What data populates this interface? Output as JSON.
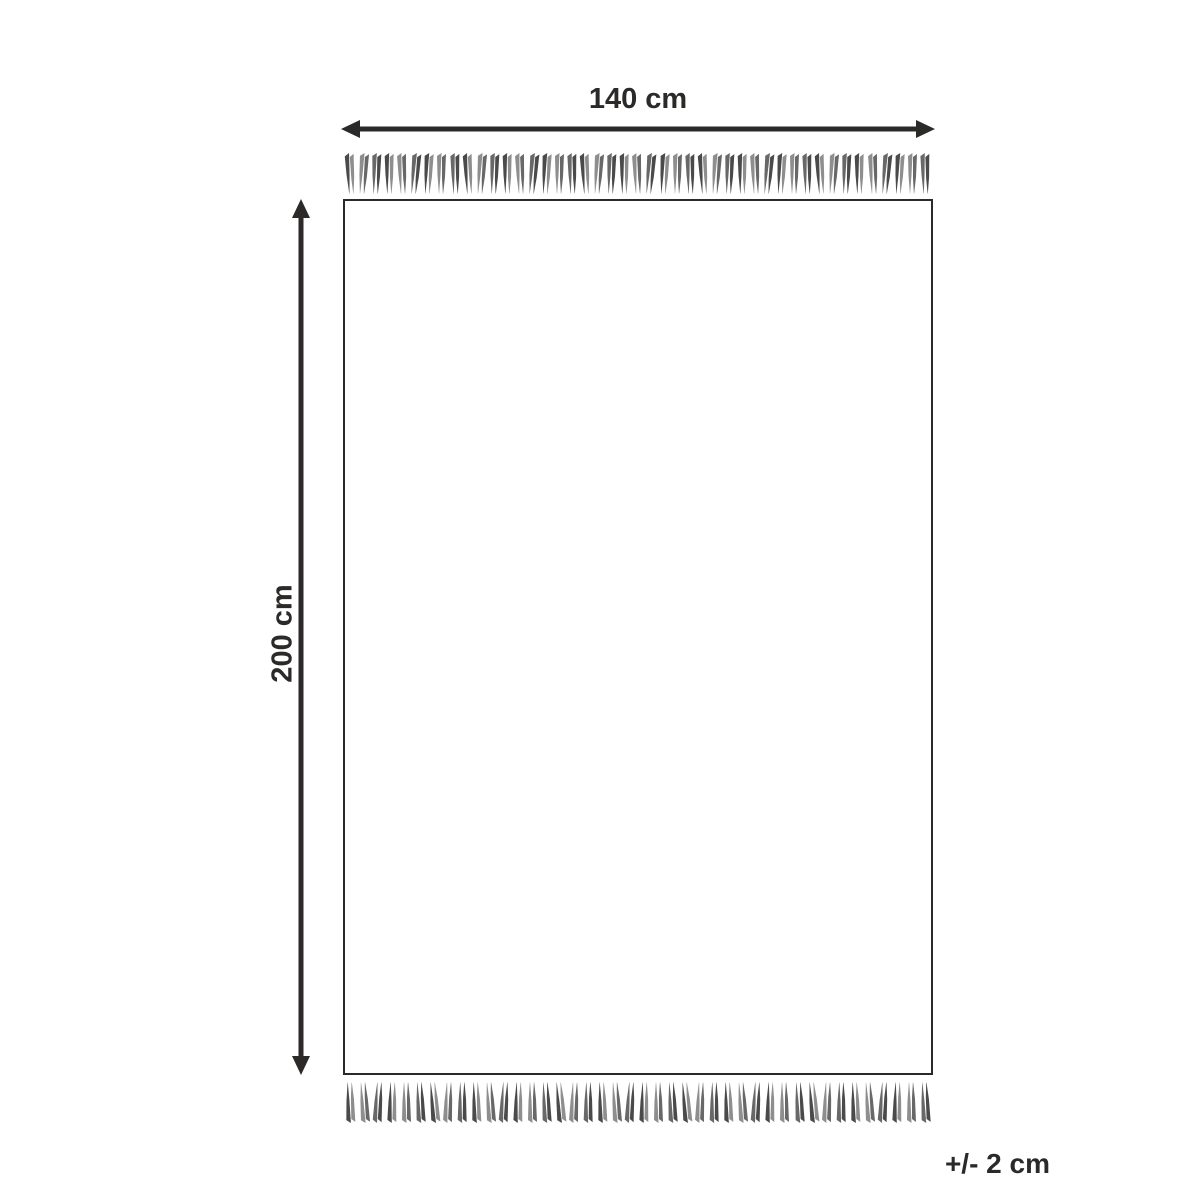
{
  "diagram": {
    "title": "rug-dimension-diagram",
    "width_label": "140 cm",
    "height_label": "200 cm",
    "tolerance_label": "+/- 2 cm",
    "line_color": "#2b2a29",
    "rug_fill": "#ffffff",
    "fringe": {
      "top_count": 45,
      "bottom_count": 42,
      "strand_colors": [
        "#4a4a4a",
        "#8e8e8e",
        "#686868"
      ],
      "tie_color": "#ffffff"
    }
  }
}
